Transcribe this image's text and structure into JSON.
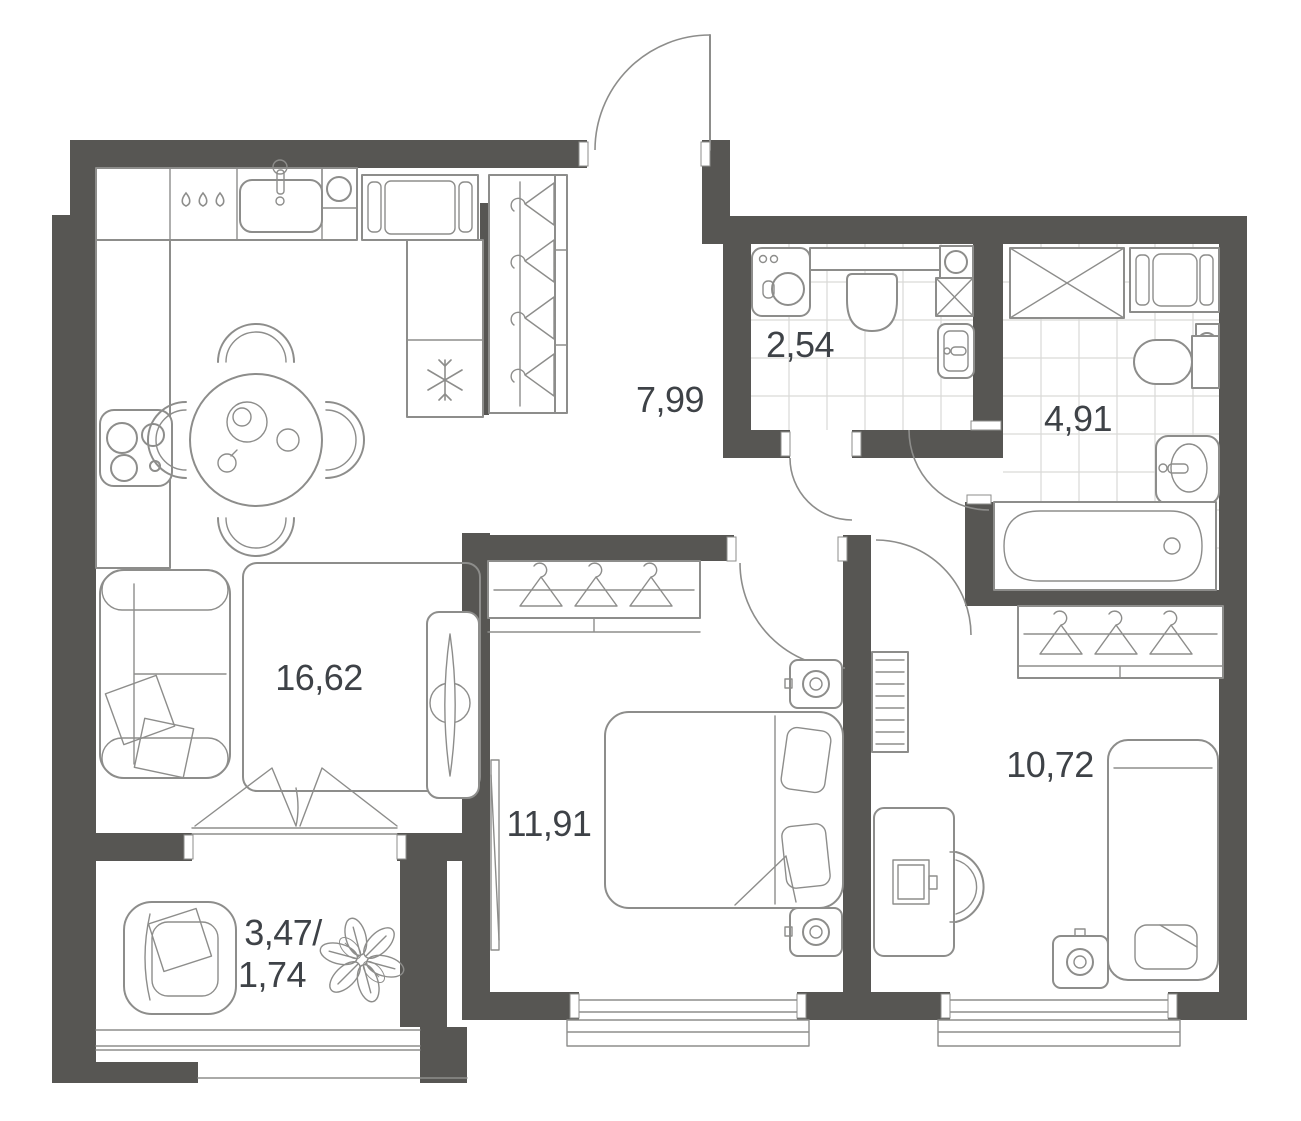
{
  "floor_plan": {
    "rooms": [
      {
        "name": "kitchen-living-room",
        "area": "16,62"
      },
      {
        "name": "hallway",
        "area": "7,99"
      },
      {
        "name": "wc",
        "area": "2,54"
      },
      {
        "name": "bathroom",
        "area": "4,91"
      },
      {
        "name": "bedroom-1",
        "area": "11,91"
      },
      {
        "name": "bedroom-2",
        "area": "10,72"
      },
      {
        "name": "balcony",
        "area_full": "3,47/",
        "area_coefficient": "1,74"
      }
    ],
    "colors": {
      "wall": "#575653",
      "furniture_line": "#8d8d8b",
      "tile_grid": "#d9d9d7",
      "label_text": "#3e4247",
      "background": "#ffffff"
    }
  }
}
